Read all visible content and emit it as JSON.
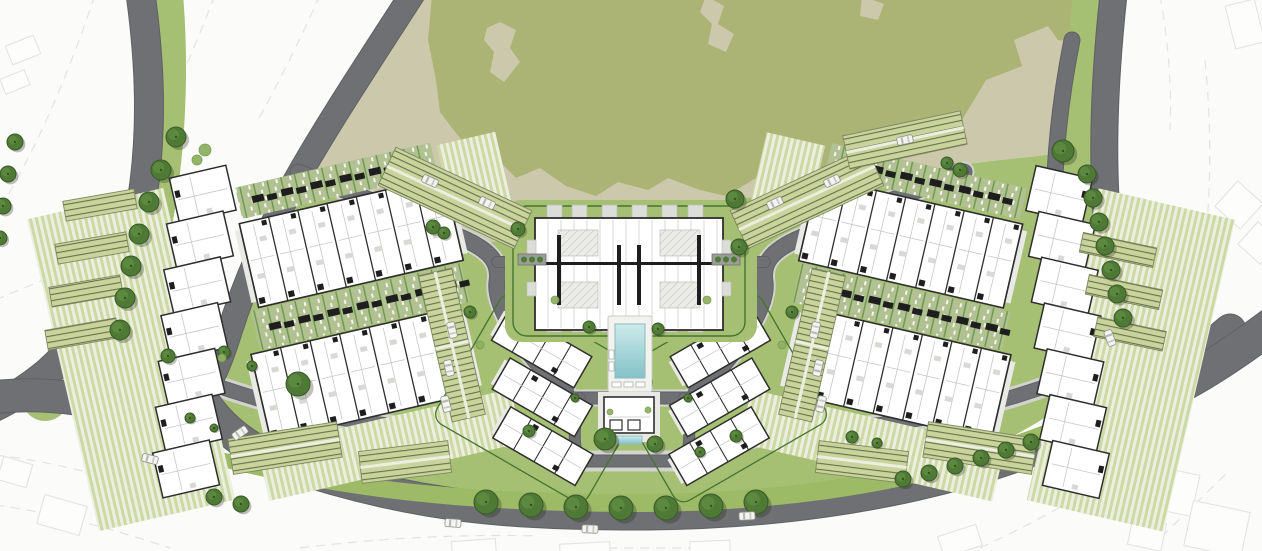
{
  "meta": {
    "drawing_type": "residential-masterplan-site-plan",
    "visible_text": []
  },
  "palette": {
    "background": "#fbfbf9",
    "ghost_line": "#e3e3e0",
    "ghost_fill": "#fdfdfc",
    "park_tan": "#cbc8ac",
    "park_olive": "#abb375",
    "band_green": "#a5c072",
    "median_green": "#9dbb66",
    "lawn_stripe_a": "#cdd9a4",
    "lawn_stripe_b": "#ecefe0",
    "garden_sage": "#b2c191",
    "garden_line": "#6f9a52",
    "hedge_green": "#46742f",
    "tree_fill": "#4e7a35",
    "tree_edge": "#3a5a28",
    "tree_light": "#5f8c41",
    "bush_fill": "#8fb161",
    "bush_edge": "#78994f",
    "tree_shadow": "rgba(40,45,25,0.30)",
    "road_gray": "#6e7073",
    "road_edge": "#5f6164",
    "aisle_gray": "#cfcfcb",
    "sidewalk": "#d2d2ce",
    "parking_bg": "#c9d39b",
    "parking_line": "#66724e",
    "parking_edge": "#7d8862",
    "parking_aisle": "#eceee0",
    "building_fill": "#ffffff",
    "building_wall": "#2e2e2e",
    "building_thin": "#c7c7c4",
    "building_core": "#1e1e1e",
    "paving_light": "#e9e9e6",
    "courtyard": "#ebebe8",
    "courtyard_line": "#cfcfcb",
    "pool_deck": "#f2f2ef",
    "pool_water_top": "#cdeaea",
    "pool_water_deep": "#83c2c9",
    "pool_rim": "#8fb9bc",
    "car_body": "#f4f4f1",
    "car_edge": "#8e8e8a",
    "car_glass": "#b9b9b4",
    "planter_gray": "#9a9c97"
  },
  "park": {
    "tan": "M426,-6 C378,64 336,124 302,182 L300,178 C340,196 420,226 466,240 C520,250 560,215 604,214 C650,212 700,205 760,196 C830,185 930,168 1000,160 C1040,156 1070,152 1092,150 L1060,120 C1062,80 1068,40 1074,-6 Z",
    "tan_poly": "M426,-6 L1074,-6 C1068,40 1062,80 1060,120 L1092,150 C1070,152 1040,156 1000,160 C930,168 830,185 760,196 C700,205 650,212 604,214 C560,215 520,250 466,240 C420,226 352,198 302,182 C336,124 378,64 426,-6 Z",
    "olive": "M432,-4 L1092,-4 L1092,2 C1088,30 1076,44 1058,40 L1048,26 L1014,40 L1022,66 L986,80 L962,120 L930,128 L900,160 L872,152 L846,178 L812,170 L790,186 L756,178 L726,196 L700,190 L668,178 L648,190 L618,182 L596,196 L566,186 L540,168 L516,178 L498,160 L470,150 L452,128 L440,112 L436,80 L428,40 Z",
    "holes": [
      "M487,28 L500,22 L516,30 L510,48 L520,62 L504,82 L490,72 L494,52 L484,40 Z",
      "M706,-4 L724,6 L718,24 L734,34 L726,52 L708,44 L712,24 L700,12 Z",
      "M862,-4 L884,4 L878,20 L860,16 Z"
    ]
  },
  "site_band": "M300,178 L466,240 C520,250 560,215 604,214 C650,212 700,205 760,196 C830,185 930,168 1000,160 C1040,156 1070,152 1092,150 C1086,220 1090,300 1112,360 C1060,420 980,460 880,485 C780,503 700,508 640,508 C520,508 420,498 330,470 C280,455 240,430 215,400 C200,370 215,330 235,290 C258,235 280,205 300,178 Z",
  "understrokes": [
    {
      "d": "M160,-5 C168,90 160,200 135,280 C118,330 85,370 45,398",
      "w": 46
    },
    {
      "d": "M1098,-5 C1088,90 1086,200 1098,280 C1106,330 1122,365 1148,392",
      "w": 50
    }
  ],
  "sidewalks": [
    {
      "d": "M206,382 C300,416 380,427 445,429 C505,431 545,447 580,461 L686,461 C721,447 761,431 821,429 C886,427 966,416 1058,382",
      "w": 21
    },
    {
      "d": "M298,172 C360,196 420,220 462,238 C492,251 500,264 497,282 C494,306 522,352 566,393",
      "w": 21
    },
    {
      "d": "M964,172 C902,196 842,220 800,238 C770,251 762,264 765,282 C768,306 740,352 696,393",
      "w": 21
    },
    {
      "d": "M566,398 L698,398",
      "w": 17
    }
  ],
  "roads": [
    {
      "name": "outer-left-road",
      "d": "M140,-10 C150,60 153,130 142,200 C128,270 95,330 48,372 C30,387 10,400 -12,410",
      "w": 28
    },
    {
      "name": "inner-left-road",
      "d": "M415,-10 C370,60 330,120 296,180 C270,226 246,280 230,330 C222,355 216,372 206,388",
      "w": 24
    },
    {
      "name": "left-arm-road",
      "d": "M-12,398 C60,388 130,406 195,432",
      "w": 32
    },
    {
      "name": "bottom-main-road",
      "d": "M196,388 C212,420 240,445 280,462 C420,510 520,514 648,514 C840,512 1010,474 1130,404 C1160,386 1195,360 1230,330",
      "w": 31
    },
    {
      "name": "right-arm-road",
      "d": "M1128,408 C1180,390 1225,360 1272,325",
      "w": 34
    },
    {
      "name": "outer-right-road",
      "d": "M1114,-10 C1104,80 1100,170 1110,250 C1117,305 1132,350 1152,383",
      "w": 26
    },
    {
      "name": "inner-right-road",
      "d": "M1072,40 C1054,130 1050,215 1058,285 C1062,320 1072,352 1088,378",
      "w": 15
    },
    {
      "name": "west-loop-road",
      "d": "M298,172 C360,196 420,220 462,238 C492,251 500,264 497,282 C494,306 522,352 566,393",
      "w": 15
    },
    {
      "name": "east-loop-road",
      "d": "M964,172 C902,196 842,220 800,238 C770,251 762,264 765,282 C768,306 740,352 696,393",
      "w": 15
    },
    {
      "name": "inner-bottom-left",
      "d": "M206,382 C300,416 380,427 445,429 C505,431 545,447 580,461",
      "w": 13
    },
    {
      "name": "inner-bottom-right",
      "d": "M1058,382 C964,416 884,427 819,429 C759,431 719,447 684,461",
      "w": 13
    },
    {
      "name": "pool-south-road",
      "d": "M566,398 L698,398",
      "w": 11
    },
    {
      "name": "club-west-road",
      "d": "M580,398 C574,420 573,442 578,461",
      "w": 10
    },
    {
      "name": "club-east-road",
      "d": "M684,398 C690,420 691,442 686,461",
      "w": 10
    },
    {
      "name": "club-south-road",
      "d": "M578,461 L686,461",
      "w": 11
    },
    {
      "name": "center-arm-west",
      "d": "M497,262 L549,262",
      "w": 10
    },
    {
      "name": "center-arm-east",
      "d": "M713,262 L765,262",
      "w": 10
    }
  ],
  "paved_stubs": [
    {
      "d": "M629,330 L629,348",
      "w": 10
    },
    {
      "d": "M629,390 L629,398",
      "w": 9
    }
  ],
  "median": "M196,460 C340,500 480,512 648,512 C840,510 1010,473 1142,402 L1128,388 C1000,452 845,492 650,494 C490,495 355,484 208,449 Z",
  "ghosts": {
    "lines": [
      "M95,-5 C70,70 40,140 8,195",
      "M215,-5 C190,60 165,115 140,165",
      "M320,-5 C300,40 280,80 258,120",
      "M-5,300 C30,285 60,275 90,255",
      "M-5,455 C60,462 130,482 200,508",
      "M-5,505 C50,512 110,528 170,548",
      "M300,548 C380,538 460,534 540,536",
      "M560,548 L700,548",
      "M980,548 C1040,520 1090,492 1130,462",
      "M1150,548 L1230,470",
      "M1205,60 C1212,130 1212,210 1200,280",
      "M1160,-5 C1168,40 1172,85 1170,130"
    ],
    "rects": [
      [
        8,
        40,
        30,
        20,
        -22
      ],
      [
        2,
        74,
        26,
        16,
        -22
      ],
      [
        1148,
        470,
        48,
        42,
        12
      ],
      [
        1188,
        506,
        58,
        46,
        12
      ],
      [
        1130,
        520,
        34,
        28,
        12
      ],
      [
        1222,
        188,
        34,
        34,
        42
      ],
      [
        1244,
        228,
        30,
        30,
        42
      ],
      [
        1230,
        2,
        30,
        44,
        -14
      ],
      [
        40,
        500,
        44,
        30,
        16
      ],
      [
        0,
        460,
        30,
        24,
        16
      ],
      [
        452,
        540,
        44,
        18,
        -4
      ],
      [
        560,
        543,
        50,
        16,
        -3
      ],
      [
        690,
        541,
        40,
        16,
        -2
      ],
      [
        940,
        530,
        40,
        22,
        -18
      ],
      [
        1050,
        2,
        20,
        30,
        10
      ]
    ]
  },
  "blocks": {
    "left": {
      "rotate": [
        -13,
        300,
        300
      ],
      "stripes": [
        [
          52,
          160,
          140,
          320
        ],
        [
          225,
          434,
          260,
          55
        ],
        [
          468,
          180,
          60,
          70
        ]
      ],
      "gardens": [
        [
          250,
          300,
          215,
          40
        ],
        [
          262,
          176,
          200,
          32
        ]
      ],
      "rows": [
        {
          "rect": [
            258,
            212,
            210,
            86
          ],
          "units": 7
        },
        {
          "rect": [
            240,
            342,
            212,
            88
          ],
          "units": 7
        }
      ],
      "zigzag": {
        "x": 200,
        "y": 152,
        "steps": 7,
        "dx": -13,
        "dy": 44,
        "w": 58,
        "h": 46
      }
    },
    "right": {
      "rotate": [
        13,
        960,
        300
      ],
      "stripes": [
        [
          1070,
          160,
          140,
          320
        ],
        [
          777,
          434,
          260,
          55
        ],
        [
          734,
          180,
          60,
          70
        ]
      ],
      "gardens": [
        [
          797,
          300,
          215,
          40
        ],
        [
          800,
          176,
          200,
          32
        ]
      ],
      "rows": [
        {
          "rect": [
            794,
            212,
            210,
            86
          ],
          "units": 7
        },
        {
          "rect": [
            810,
            342,
            212,
            88
          ],
          "units": 7
        }
      ],
      "zigzag": {
        "x": 1004,
        "y": 152,
        "steps": 7,
        "dx": 13,
        "dy": 44,
        "w": 58,
        "h": 46
      }
    },
    "flank_left": {
      "rotate": [
        30,
        535,
        385
      ],
      "slabs": [
        [
          475,
          332,
          95,
          36
        ],
        [
          500,
          374,
          95,
          36
        ],
        [
          525,
          416,
          95,
          36
        ]
      ],
      "hedge": [
        462,
        318,
        175,
        148
      ]
    },
    "flank_right": {
      "rotate": [
        -30,
        727,
        385
      ],
      "slabs": [
        [
          692,
          332,
          95,
          36
        ],
        [
          667,
          374,
          95,
          36
        ],
        [
          642,
          416,
          95,
          36
        ]
      ],
      "hedge": [
        625,
        318,
        175,
        148
      ]
    }
  },
  "center_cluster": {
    "pad": [
      505,
      200,
      252,
      142
    ],
    "hedge": [
      513,
      206,
      232,
      130
    ],
    "body": [
      535,
      218,
      188,
      112
    ],
    "balcony_xs": [
      547,
      572,
      602,
      632,
      662,
      688
    ],
    "balcony_top_y": 205,
    "balcony_bot_y": 318,
    "balcony_w": 15,
    "balcony_h": 14,
    "courtyards": [
      [
        558,
        230,
        40,
        26
      ],
      [
        660,
        230,
        40,
        26
      ],
      [
        558,
        282,
        40,
        26
      ],
      [
        660,
        282,
        40,
        26
      ]
    ],
    "cores": [
      [
        557,
        235,
        4,
        70
      ],
      [
        617,
        245,
        4,
        60
      ],
      [
        637,
        245,
        4,
        60
      ],
      [
        697,
        235,
        4,
        70
      ]
    ],
    "spine": [
      545,
      262,
      170,
      3
    ],
    "side_balconies": [
      [
        527,
        240,
        9,
        14
      ],
      [
        722,
        240,
        9,
        14
      ],
      [
        527,
        282,
        9,
        14
      ],
      [
        722,
        282,
        9,
        14
      ]
    ],
    "planters": [
      [
        518,
        254,
        28,
        11
      ],
      [
        712,
        254,
        28,
        11
      ]
    ]
  },
  "pool": {
    "deck": [
      608,
      316,
      44,
      76
    ],
    "water": [
      615,
      324,
      30,
      54
    ],
    "loungers": [
      [
        612,
        382,
        9,
        5
      ],
      [
        624,
        382,
        9,
        5
      ],
      [
        636,
        382,
        9,
        5
      ],
      [
        609,
        350,
        5,
        9
      ],
      [
        609,
        362,
        5,
        9
      ]
    ]
  },
  "clubhouse": {
    "pad": [
      598,
      392,
      62,
      50
    ],
    "building": [
      604,
      397,
      50,
      36
    ],
    "rooms": [
      [
        610,
        420,
        12,
        10
      ],
      [
        628,
        420,
        12,
        10
      ]
    ],
    "water": [
      616,
      436,
      26,
      8
    ]
  },
  "parking_strips": [
    {
      "cx": 455,
      "cy": 198,
      "w": 150,
      "h": 42,
      "rot": 25
    },
    {
      "cx": 807,
      "cy": 198,
      "w": 150,
      "h": 42,
      "rot": -25
    },
    {
      "cx": 100,
      "cy": 205,
      "w": 72,
      "h": 20,
      "rot": -10
    },
    {
      "cx": 92,
      "cy": 248,
      "w": 72,
      "h": 20,
      "rot": -10
    },
    {
      "cx": 86,
      "cy": 291,
      "w": 72,
      "h": 20,
      "rot": -10
    },
    {
      "cx": 82,
      "cy": 334,
      "w": 72,
      "h": 20,
      "rot": -10
    },
    {
      "cx": 452,
      "cy": 345,
      "w": 34,
      "h": 150,
      "rot": -13
    },
    {
      "cx": 285,
      "cy": 448,
      "w": 110,
      "h": 36,
      "rot": -9
    },
    {
      "cx": 405,
      "cy": 462,
      "w": 90,
      "h": 32,
      "rot": -7
    },
    {
      "cx": 1118,
      "cy": 250,
      "w": 75,
      "h": 20,
      "rot": 12
    },
    {
      "cx": 1124,
      "cy": 292,
      "w": 75,
      "h": 20,
      "rot": 12
    },
    {
      "cx": 1130,
      "cy": 334,
      "w": 70,
      "h": 20,
      "rot": 12
    },
    {
      "cx": 812,
      "cy": 345,
      "w": 34,
      "h": 150,
      "rot": 13
    },
    {
      "cx": 980,
      "cy": 448,
      "w": 110,
      "h": 36,
      "rot": 9
    },
    {
      "cx": 862,
      "cy": 462,
      "w": 90,
      "h": 32,
      "rot": 7
    },
    {
      "cx": 905,
      "cy": 140,
      "w": 120,
      "h": 34,
      "rot": -12
    }
  ],
  "trees": [
    [
      15,
      142,
      8
    ],
    [
      8,
      174,
      8
    ],
    [
      3,
      206,
      8
    ],
    [
      0,
      238,
      7
    ],
    [
      176,
      137,
      10
    ],
    [
      161,
      170,
      10
    ],
    [
      149,
      202,
      10
    ],
    [
      139,
      234,
      10
    ],
    [
      131,
      266,
      10
    ],
    [
      125,
      298,
      10
    ],
    [
      120,
      330,
      10
    ],
    [
      1063,
      151,
      11
    ],
    [
      1087,
      174,
      9
    ],
    [
      1093,
      198,
      9
    ],
    [
      1099,
      222,
      9
    ],
    [
      1105,
      246,
      9
    ],
    [
      1111,
      270,
      9
    ],
    [
      1117,
      294,
      9
    ],
    [
      1123,
      318,
      9
    ],
    [
      486,
      502,
      12
    ],
    [
      531,
      505,
      12
    ],
    [
      576,
      507,
      12
    ],
    [
      621,
      508,
      12
    ],
    [
      666,
      508,
      12
    ],
    [
      711,
      506,
      12
    ],
    [
      756,
      502,
      12
    ],
    [
      214,
      497,
      8
    ],
    [
      241,
      504,
      8
    ],
    [
      903,
      479,
      8
    ],
    [
      929,
      473,
      8
    ],
    [
      955,
      466,
      8
    ],
    [
      981,
      458,
      8
    ],
    [
      1006,
      450,
      8
    ],
    [
      1031,
      442,
      8
    ],
    [
      298,
      384,
      12
    ],
    [
      224,
      352,
      6
    ],
    [
      252,
      366,
      5
    ],
    [
      168,
      356,
      7
    ],
    [
      433,
      227,
      7
    ],
    [
      444,
      233,
      6
    ],
    [
      735,
      199,
      9
    ],
    [
      739,
      247,
      8
    ],
    [
      518,
      229,
      7
    ],
    [
      960,
      170,
      7
    ],
    [
      947,
      163,
      6
    ],
    [
      852,
      437,
      6
    ],
    [
      877,
      443,
      5
    ],
    [
      700,
      452,
      5
    ],
    [
      529,
      431,
      6
    ],
    [
      605,
      439,
      11
    ],
    [
      655,
      444,
      8
    ],
    [
      589,
      327,
      6
    ],
    [
      658,
      329,
      6
    ],
    [
      736,
      436,
      6
    ],
    [
      575,
      398,
      4
    ],
    [
      688,
      398,
      4
    ],
    [
      470,
      312,
      6
    ],
    [
      792,
      312,
      6
    ],
    [
      190,
      418,
      5
    ],
    [
      214,
      428,
      4
    ]
  ],
  "bushes": [
    [
      205,
      150,
      6
    ],
    [
      197,
      160,
      5
    ],
    [
      222,
      358,
      4
    ],
    [
      610,
      412,
      3
    ],
    [
      648,
      410,
      3
    ],
    [
      480,
      345,
      4
    ],
    [
      782,
      345,
      4
    ],
    [
      555,
      300,
      4
    ],
    [
      707,
      300,
      4
    ]
  ],
  "cars": [
    [
      150,
      459,
      14
    ],
    [
      453,
      523,
      4
    ],
    [
      590,
      529,
      2
    ],
    [
      747,
      516,
      -3
    ],
    [
      1110,
      338,
      70
    ],
    [
      430,
      181,
      25
    ],
    [
      487,
      203,
      25
    ],
    [
      832,
      181,
      -25
    ],
    [
      775,
      203,
      -25
    ],
    [
      452,
      330,
      77
    ],
    [
      449,
      368,
      77
    ],
    [
      446,
      404,
      77
    ],
    [
      815,
      330,
      -77
    ],
    [
      818,
      368,
      -77
    ],
    [
      821,
      404,
      -77
    ],
    [
      240,
      433,
      -35
    ],
    [
      905,
      140,
      -12
    ]
  ]
}
